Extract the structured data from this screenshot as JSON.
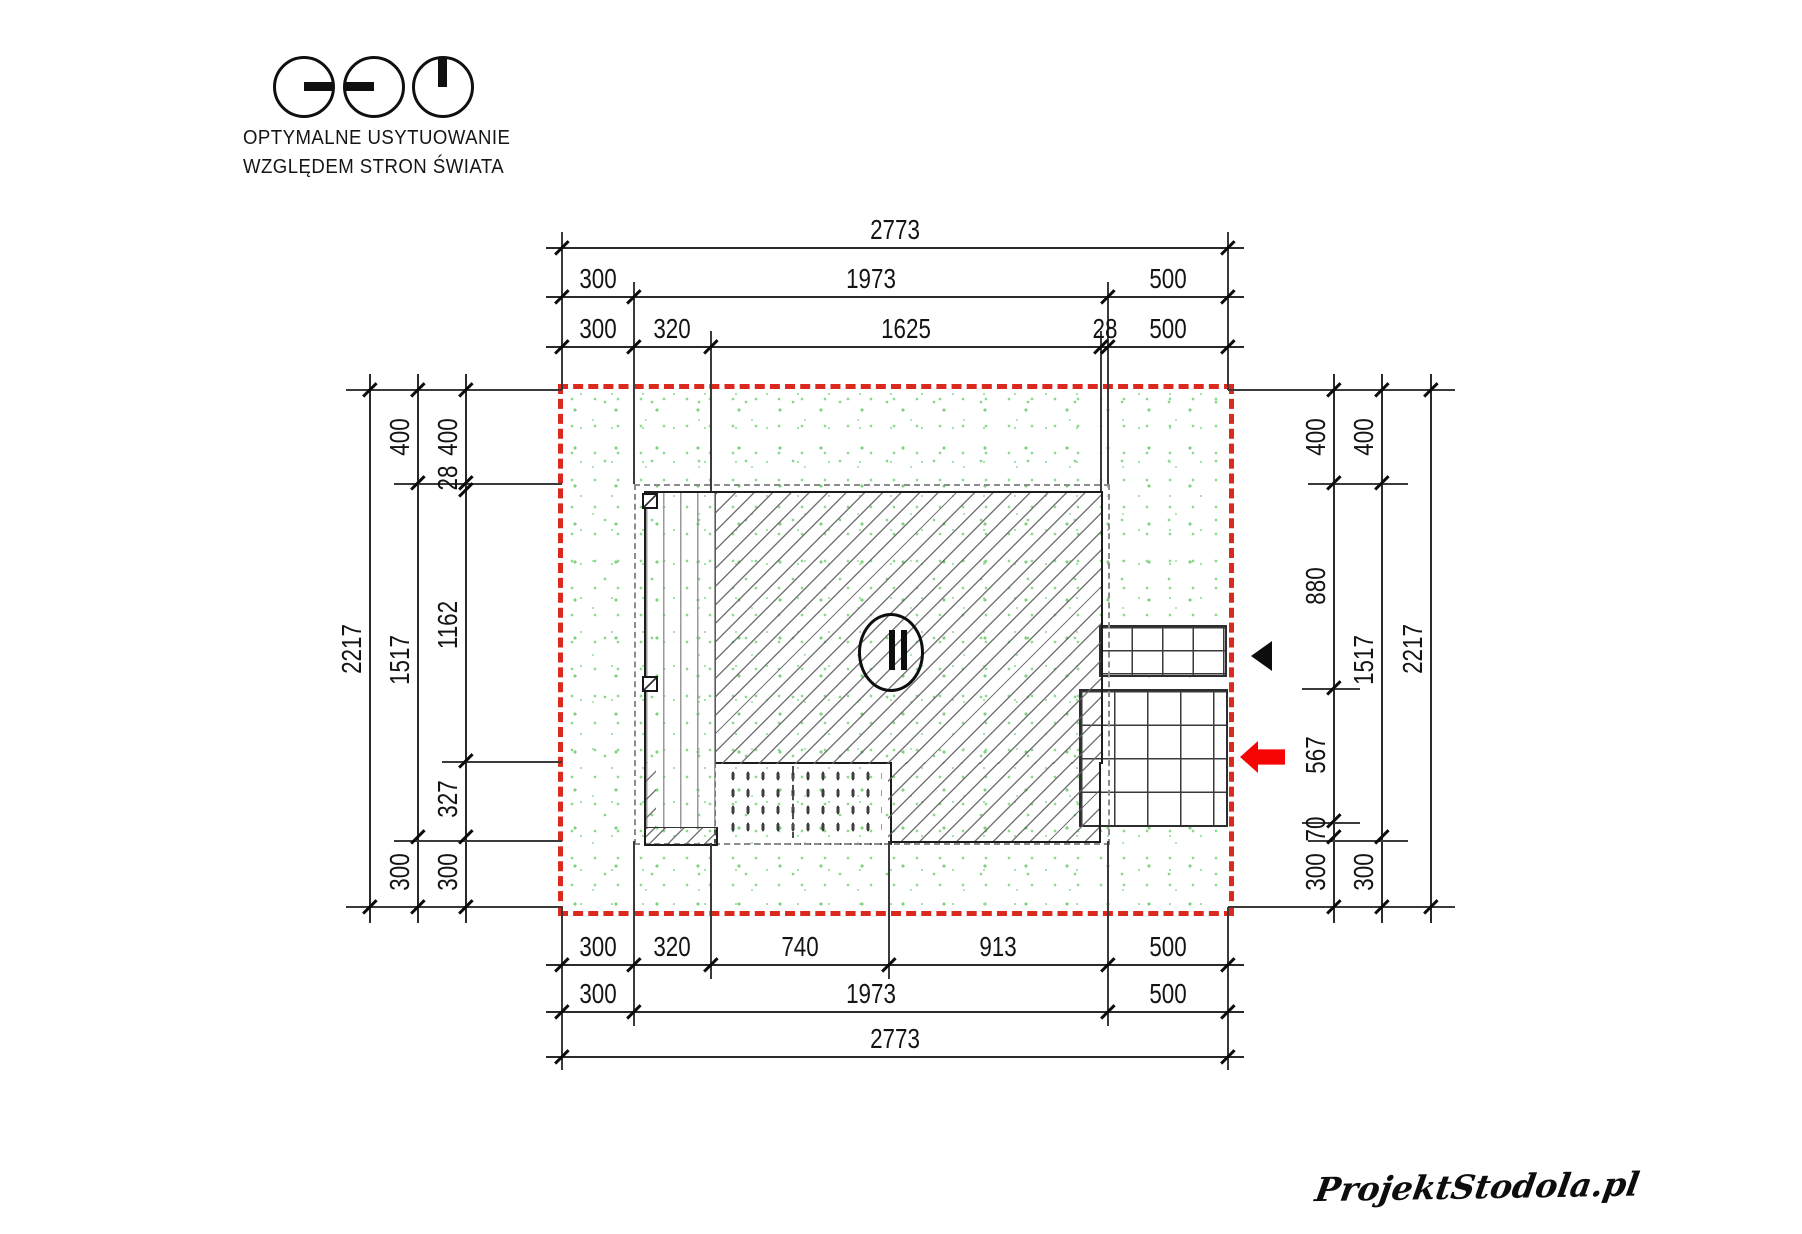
{
  "legend": {
    "line1": "OPTYMALNE USYTUOWANIE",
    "line2": "WZGLĘDEM STRON ŚWIATA",
    "symbols": [
      "sun-ray-east",
      "sun-ray-west",
      "sun-ray-north"
    ]
  },
  "site_plan": {
    "plot_total_width": 2773,
    "plot_total_height": 2217,
    "dimensions": {
      "top_rows": [
        [
          "2773"
        ],
        [
          "300",
          "1973",
          "500"
        ],
        [
          "300",
          "320",
          "1625",
          "28",
          "500"
        ]
      ],
      "bottom_rows": [
        [
          "300",
          "320",
          "740",
          "913",
          "500"
        ],
        [
          "300",
          "1973",
          "500"
        ],
        [
          "2773"
        ]
      ],
      "left_columns": [
        [
          "2217"
        ],
        [
          "400",
          "1517",
          "300"
        ],
        [
          "400",
          "28",
          "1162",
          "327",
          "300"
        ]
      ],
      "right_columns": [
        [
          "400",
          "880",
          "567",
          "70",
          "300"
        ],
        [
          "400",
          "1517",
          "300"
        ],
        [
          "2217"
        ]
      ]
    },
    "tree_symbol": "II"
  },
  "colors": {
    "boundary_red": "#dc291d",
    "arrow_red": "#f70505",
    "lawn_dot_green": "#8fd98f",
    "dim_line": "#2a2a2a",
    "hatch_gray": "#5f5f5f",
    "roof_dash_gray": "#8c8c8c"
  },
  "watermark": {
    "text": "ProjektStodola.pl"
  }
}
